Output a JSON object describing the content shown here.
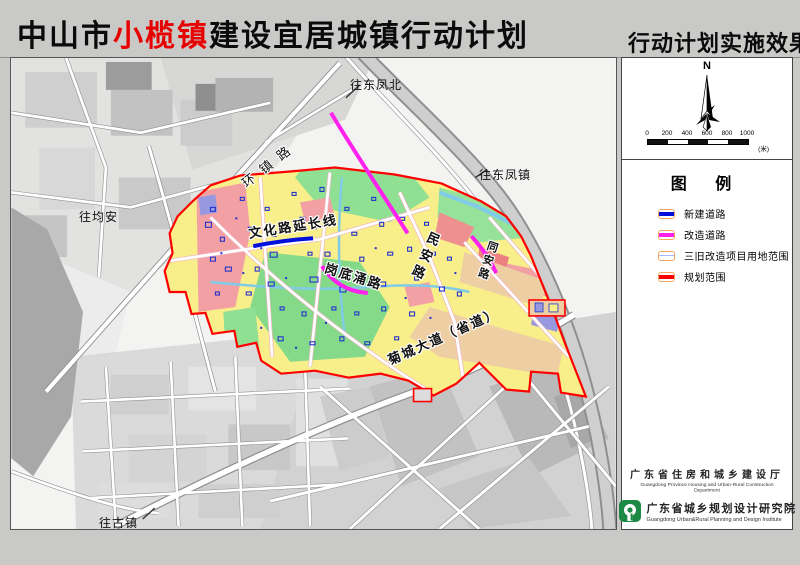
{
  "page": {
    "title_prefix": "中山市",
    "title_highlight": "小榄镇",
    "title_suffix": "建设宜居城镇行动计划"
  },
  "sidebar": {
    "title": "行动计划实施效果图",
    "north_label": "N",
    "scale": {
      "ticks": [
        "0",
        "200",
        "400",
        "600",
        "800",
        "1000"
      ],
      "unit": "(米)"
    },
    "legend": {
      "heading": "图 例",
      "items": [
        {
          "label": "新建道路",
          "color": "#0011dd"
        },
        {
          "label": "改造道路",
          "color": "#ff22ee"
        },
        {
          "label": "三旧改造项目用地范围",
          "color": "#aab7ff"
        },
        {
          "label": "规划范围",
          "color": "#ff0000"
        }
      ]
    },
    "credits": {
      "dept_cn": "广东省住房和城乡建设厅",
      "dept_en": "Guangdong Province Housing and Urban-Rural Construction Department",
      "inst_cn": "广东省城乡规划设计研究院",
      "inst_en": "Guangdong Urban&Rural Planning and Design Institute"
    }
  },
  "map": {
    "labels": {
      "dongfengbei": "往东凤北",
      "huanzhenlu": "环镇路",
      "wenhualu": "文化路延长线",
      "gangdiyonglu": "岗底涌路",
      "minanlu": "民安路",
      "tonganlu": "同安路",
      "juchengdadao": "菊城大道（省道）",
      "dongfengzhen": "往东凤镇",
      "junan": "往均安",
      "guzhen": "往古镇"
    }
  },
  "colors": {
    "title_highlight_red": "#e60000",
    "boundary_red": "#ff0000",
    "new_road_blue": "#0011dd",
    "rebuild_road_magenta": "#ff22ee",
    "planning_yellow": "#f8ee8a",
    "park_green": "#90e094",
    "pink_block": "#f2a0a4",
    "peach_block": "#eecfa4",
    "water_cyan": "#7fcbe8",
    "logo_green": "#1c8a45",
    "band_gray": "#c9c9c7"
  }
}
